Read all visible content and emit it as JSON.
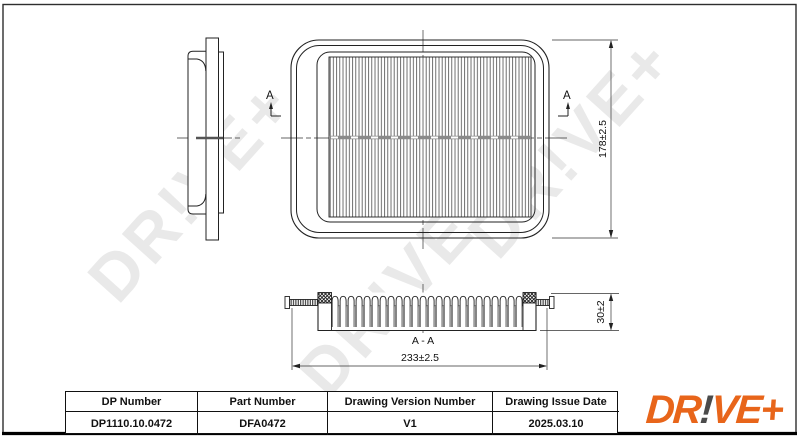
{
  "drawing": {
    "watermark": "DR!VE+",
    "section_marker_left": "A",
    "section_marker_right": "A",
    "section_title": "A - A",
    "dim_height": "178±2.5",
    "dim_width": "233±2.5",
    "dim_thickness": "30±2"
  },
  "table": {
    "columns": [
      {
        "header": "DP Number",
        "value": "DP1110.10.0472"
      },
      {
        "header": "Part Number",
        "value": "DFA0472"
      },
      {
        "header": "Drawing Version Number",
        "value": "V1"
      },
      {
        "header": "Drawing Issue Date",
        "value": "2025.03.10"
      }
    ]
  },
  "logo": {
    "prefix": "DR",
    "bang": "!",
    "suffix": "VE+"
  },
  "colors": {
    "line": "#2e2e2e",
    "watermark": "#e9e9e9",
    "logo_orange": "#E8651A",
    "logo_gray": "#4B4B4B"
  }
}
